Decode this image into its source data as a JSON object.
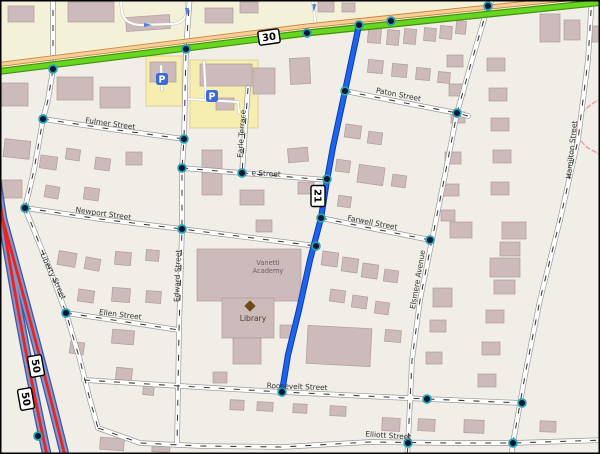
{
  "map": {
    "colors": {
      "bg": "#f1eee8",
      "band": "#f3f1d8",
      "yellow_area": "#f6eeb0",
      "yellow_edge": "#d9cc8a",
      "building_fill": "#cdbaba",
      "building_edge": "#b09c9c",
      "street_casing": "#9a9a9a",
      "street_fill": "#ffffff",
      "street_dash": "#3a3a3a",
      "green_fill": "#68d51f",
      "green_edge": "#3d930f",
      "tan_fill": "#f7cf9a",
      "tan_edge": "#c8863c",
      "blue_route": "#1e63ef",
      "blue_route_edge": "#0a3da6",
      "motorway_fill": "#8295cc",
      "motorway_edge": "#40549c",
      "motorway_red": "#e8241f",
      "node_core": "#0e1530",
      "node_ring": "#26a5b8",
      "pink_path": "#f0a0a0",
      "label_color": "#333333",
      "parking_blue": "#3b6bd6",
      "library_brown": "#6d4b16",
      "poi_label_color": "#4d3b2a",
      "academy_label_color": "#6b5d6b",
      "arrow_blue": "#4f7fe8",
      "shield_fill": "#ffffff",
      "shield_edge": "#000000"
    },
    "band_path": "M-5,75 L605,3 L605,-6 L-5,-6 Z",
    "yellow_areas": [
      [
        146,
        56,
        36,
        50
      ],
      [
        190,
        60,
        68,
        68
      ]
    ],
    "green_road": [
      [
        -5,
        72
      ],
      [
        307,
        33
      ],
      [
        605,
        2
      ]
    ],
    "tan_road": [
      [
        -5,
        65
      ],
      [
        307,
        26
      ],
      [
        605,
        -5
      ]
    ],
    "blue_route": [
      [
        359,
        25
      ],
      [
        345,
        91
      ],
      [
        333,
        147
      ],
      [
        327,
        180
      ],
      [
        321,
        218
      ],
      [
        310,
        260
      ],
      [
        299,
        310
      ],
      [
        288,
        355
      ],
      [
        282,
        392
      ]
    ],
    "motorway": [
      "M-8,148 C2,220 20,330 48,460",
      "M-8,180 C8,240 34,330 66,460"
    ],
    "pink_path": "M602,98 C578,110 566,130 588,148 L603,156",
    "streets": [
      [
        [
          53,
          -5
        ],
        [
          53,
          69
        ],
        [
          48,
          100
        ],
        [
          43,
          119
        ],
        [
          34,
          170
        ],
        [
          25,
          208
        ]
      ],
      [
        [
          25,
          208
        ],
        [
          50,
          270
        ],
        [
          66,
          313
        ],
        [
          80,
          360
        ],
        [
          90,
          400
        ],
        [
          98,
          428
        ]
      ],
      [
        [
          98,
          428
        ],
        [
          140,
          443
        ],
        [
          200,
          446
        ],
        [
          282,
          447
        ],
        [
          370,
          442
        ],
        [
          450,
          443
        ],
        [
          513,
          443
        ],
        [
          605,
          440
        ]
      ],
      [
        [
          190,
          -5
        ],
        [
          186,
          49
        ],
        [
          184,
          139
        ],
        [
          182,
          168
        ],
        [
          182,
          229
        ],
        [
          179,
          330
        ],
        [
          178,
          390
        ],
        [
          177,
          445
        ]
      ],
      [
        [
          43,
          119
        ],
        [
          110,
          129
        ],
        [
          184,
          139
        ]
      ],
      [
        [
          182,
          168
        ],
        [
          242,
          173
        ],
        [
          327,
          180
        ]
      ],
      [
        [
          25,
          208
        ],
        [
          100,
          219
        ],
        [
          182,
          229
        ],
        [
          316,
          246
        ]
      ],
      [
        [
          66,
          313
        ],
        [
          120,
          321
        ],
        [
          179,
          330
        ]
      ],
      [
        [
          84,
          380
        ],
        [
          180,
          386
        ],
        [
          282,
          392
        ],
        [
          427,
          399
        ],
        [
          522,
          403
        ]
      ],
      [
        [
          345,
          91
        ],
        [
          400,
          102
        ],
        [
          457,
          113
        ],
        [
          468,
          116
        ]
      ],
      [
        [
          321,
          218
        ],
        [
          375,
          229
        ],
        [
          430,
          240
        ]
      ],
      [
        [
          496,
          -6
        ],
        [
          488,
          6
        ],
        [
          472,
          60
        ],
        [
          457,
          113
        ],
        [
          444,
          180
        ],
        [
          432,
          240
        ],
        [
          420,
          300
        ],
        [
          412,
          360
        ],
        [
          408,
          443
        ],
        [
          407,
          459
        ]
      ],
      [
        [
          592,
          -5
        ],
        [
          588,
          60
        ],
        [
          578,
          140
        ],
        [
          560,
          220
        ],
        [
          540,
          300
        ],
        [
          526,
          370
        ],
        [
          513,
          443
        ],
        [
          511,
          459
        ]
      ],
      [
        [
          248,
          88
        ],
        [
          245,
          130
        ],
        [
          242,
          173
        ]
      ]
    ],
    "service_paths": [
      "M120,-5 L122,12 Q124,24 140,25 L172,24 Q186,23 187,10 L187,-5",
      "M312,-5 L314,12 L316,26",
      "M204,62 L206,100 L238,102",
      "M206,100 L186,99",
      "M238,102 L239,113",
      "M161,66 L162,90"
    ],
    "street_labels": [
      {
        "text": "Fulmer Street",
        "x": 110,
        "y": 126,
        "rot": 8
      },
      {
        "text": "e Street",
        "x": 266,
        "y": 176,
        "rot": 3
      },
      {
        "text": "Newport Street",
        "x": 103,
        "y": 216,
        "rot": 8
      },
      {
        "text": "Paton Street",
        "x": 398,
        "y": 97,
        "rot": 11
      },
      {
        "text": "Farwell Street",
        "x": 372,
        "y": 225,
        "rot": 11
      },
      {
        "text": "Ellen Street",
        "x": 120,
        "y": 317,
        "rot": 7
      },
      {
        "text": "Roosevelt Street",
        "x": 297,
        "y": 389,
        "rot": 2
      },
      {
        "text": "Elliott Street",
        "x": 388,
        "y": 438,
        "rot": 4
      },
      {
        "text": "Liberty Street",
        "x": 51,
        "y": 277,
        "rot": 65
      },
      {
        "text": "Edward Street",
        "x": 180,
        "y": 276,
        "rot": -88
      },
      {
        "text": "Earle Terrace",
        "x": 244,
        "y": 134,
        "rot": -86
      },
      {
        "text": "Elsmere Avenue",
        "x": 420,
        "y": 280,
        "rot": -80
      },
      {
        "text": "Hamilton Street",
        "x": 574,
        "y": 150,
        "rot": -84
      }
    ],
    "shields": [
      {
        "text": "30",
        "x": 269,
        "y": 37,
        "rot": -8
      },
      {
        "text": "21",
        "x": 318,
        "y": 196,
        "rot": 90
      },
      {
        "text": "50",
        "x": 36,
        "y": 366,
        "rot": 80
      },
      {
        "text": "50",
        "x": 26,
        "y": 399,
        "rot": 80
      }
    ],
    "nodes": [
      [
        53,
        69
      ],
      [
        186,
        49
      ],
      [
        307,
        33
      ],
      [
        359,
        25
      ],
      [
        391,
        21
      ],
      [
        488,
        6
      ],
      [
        43,
        119
      ],
      [
        25,
        208
      ],
      [
        66,
        313
      ],
      [
        38,
        436
      ],
      [
        184,
        139
      ],
      [
        182,
        168
      ],
      [
        182,
        229
      ],
      [
        242,
        173
      ],
      [
        345,
        91
      ],
      [
        327,
        179
      ],
      [
        321,
        218
      ],
      [
        316,
        246
      ],
      [
        282,
        392
      ],
      [
        457,
        113
      ],
      [
        430,
        240
      ],
      [
        427,
        399
      ],
      [
        522,
        403
      ],
      [
        408,
        443
      ],
      [
        513,
        443
      ]
    ],
    "arrows": [
      {
        "x": 148,
        "y": 25,
        "rot": 0
      },
      {
        "x": 187,
        "y": 12,
        "rot": 90
      },
      {
        "x": 314,
        "y": 8,
        "rot": 95
      }
    ],
    "buildings": [
      [
        8,
        6,
        26,
        16,
        0
      ],
      [
        68,
        2,
        46,
        20,
        0
      ],
      [
        126,
        16,
        44,
        14,
        -4
      ],
      [
        205,
        8,
        28,
        15,
        0
      ],
      [
        240,
        2,
        18,
        11,
        0
      ],
      [
        318,
        0,
        16,
        12,
        0
      ],
      [
        342,
        3,
        13,
        9,
        0
      ],
      [
        540,
        14,
        20,
        28,
        0
      ],
      [
        564,
        20,
        16,
        20,
        0
      ],
      [
        592,
        26,
        10,
        16,
        0
      ],
      [
        0,
        83,
        28,
        23,
        0
      ],
      [
        57,
        77,
        36,
        23,
        0
      ],
      [
        100,
        87,
        30,
        21,
        0
      ],
      [
        4,
        140,
        26,
        18,
        6
      ],
      [
        2,
        180,
        20,
        18,
        0
      ],
      [
        150,
        62,
        26,
        20,
        0
      ],
      [
        200,
        64,
        52,
        22,
        0
      ],
      [
        216,
        98,
        18,
        12,
        0
      ],
      [
        253,
        68,
        22,
        26,
        0
      ],
      [
        290,
        58,
        20,
        26,
        -3
      ],
      [
        40,
        156,
        17,
        13,
        8
      ],
      [
        66,
        149,
        14,
        11,
        8
      ],
      [
        95,
        158,
        15,
        12,
        8
      ],
      [
        45,
        186,
        14,
        12,
        10
      ],
      [
        84,
        188,
        15,
        12,
        8
      ],
      [
        126,
        152,
        16,
        13,
        0
      ],
      [
        202,
        150,
        20,
        45,
        0
      ],
      [
        240,
        190,
        24,
        15,
        0
      ],
      [
        288,
        148,
        20,
        14,
        -5
      ],
      [
        298,
        182,
        16,
        12,
        0
      ],
      [
        256,
        220,
        16,
        12,
        0
      ],
      [
        368,
        27,
        13,
        16,
        5
      ],
      [
        387,
        30,
        12,
        15,
        5
      ],
      [
        404,
        29,
        12,
        15,
        5
      ],
      [
        424,
        28,
        12,
        13,
        5
      ],
      [
        440,
        26,
        12,
        13,
        5
      ],
      [
        456,
        21,
        10,
        13,
        5
      ],
      [
        368,
        60,
        15,
        13,
        5
      ],
      [
        392,
        64,
        15,
        13,
        5
      ],
      [
        416,
        68,
        14,
        12,
        5
      ],
      [
        438,
        72,
        12,
        11,
        5
      ],
      [
        345,
        125,
        16,
        13,
        8
      ],
      [
        368,
        132,
        14,
        12,
        8
      ],
      [
        336,
        160,
        14,
        12,
        8
      ],
      [
        358,
        166,
        26,
        18,
        8
      ],
      [
        392,
        175,
        14,
        12,
        8
      ],
      [
        338,
        196,
        13,
        11,
        8
      ],
      [
        322,
        252,
        16,
        14,
        8
      ],
      [
        342,
        258,
        16,
        14,
        8
      ],
      [
        362,
        264,
        16,
        14,
        8
      ],
      [
        384,
        270,
        14,
        12,
        8
      ],
      [
        330,
        290,
        15,
        12,
        8
      ],
      [
        352,
        296,
        15,
        12,
        8
      ],
      [
        375,
        302,
        14,
        12,
        8
      ],
      [
        307,
        327,
        64,
        38,
        3
      ],
      [
        385,
        330,
        16,
        12,
        5
      ],
      [
        230,
        400,
        14,
        10,
        3
      ],
      [
        257,
        402,
        16,
        9,
        3
      ],
      [
        293,
        404,
        14,
        9,
        3
      ],
      [
        330,
        406,
        16,
        10,
        3
      ],
      [
        382,
        418,
        18,
        13,
        3
      ],
      [
        418,
        419,
        17,
        12,
        3
      ],
      [
        464,
        420,
        20,
        13,
        2
      ],
      [
        540,
        421,
        16,
        11,
        2
      ],
      [
        100,
        438,
        24,
        12,
        4
      ],
      [
        152,
        443,
        18,
        9,
        3
      ],
      [
        58,
        252,
        18,
        14,
        10
      ],
      [
        85,
        258,
        15,
        12,
        10
      ],
      [
        115,
        252,
        16,
        13,
        5
      ],
      [
        146,
        250,
        13,
        11,
        5
      ],
      [
        78,
        290,
        16,
        12,
        8
      ],
      [
        112,
        288,
        18,
        14,
        4
      ],
      [
        146,
        291,
        15,
        12,
        4
      ],
      [
        70,
        342,
        14,
        12,
        8
      ],
      [
        112,
        330,
        22,
        14,
        5
      ],
      [
        116,
        368,
        16,
        12,
        6
      ],
      [
        143,
        384,
        11,
        11,
        5
      ],
      [
        197,
        249,
        104,
        52,
        0
      ],
      [
        222,
        298,
        52,
        40,
        0
      ],
      [
        233,
        338,
        28,
        26,
        0
      ],
      [
        213,
        372,
        14,
        11,
        0
      ],
      [
        280,
        325,
        12,
        13,
        0
      ],
      [
        447,
        55,
        16,
        12,
        0
      ],
      [
        449,
        84,
        16,
        12,
        0
      ],
      [
        451,
        112,
        14,
        11,
        0
      ],
      [
        445,
        152,
        16,
        12,
        0
      ],
      [
        443,
        184,
        16,
        12,
        0
      ],
      [
        441,
        210,
        14,
        11,
        0
      ],
      [
        487,
        58,
        18,
        13,
        0
      ],
      [
        489,
        88,
        18,
        13,
        0
      ],
      [
        491,
        118,
        18,
        13,
        0
      ],
      [
        493,
        150,
        18,
        13,
        0
      ],
      [
        491,
        182,
        18,
        13,
        0
      ],
      [
        450,
        222,
        22,
        16,
        0
      ],
      [
        502,
        222,
        24,
        17,
        0
      ],
      [
        500,
        242,
        20,
        14,
        0
      ],
      [
        490,
        258,
        30,
        19,
        0
      ],
      [
        494,
        280,
        21,
        14,
        0
      ],
      [
        433,
        288,
        19,
        19,
        0
      ],
      [
        486,
        310,
        18,
        13,
        0
      ],
      [
        482,
        342,
        18,
        13,
        0
      ],
      [
        478,
        374,
        18,
        13,
        0
      ],
      [
        430,
        320,
        16,
        12,
        0
      ],
      [
        426,
        352,
        16,
        12,
        0
      ]
    ],
    "pois": {
      "library": {
        "label": "Library",
        "icon_x": 250,
        "icon_y": 306,
        "label_x": 253,
        "label_y": 321
      },
      "academy": {
        "lines": [
          "Vanetti",
          "Academy"
        ],
        "x": 268,
        "y": 265
      },
      "parking": [
        [
          162,
          79
        ],
        [
          212,
          96
        ]
      ]
    }
  }
}
